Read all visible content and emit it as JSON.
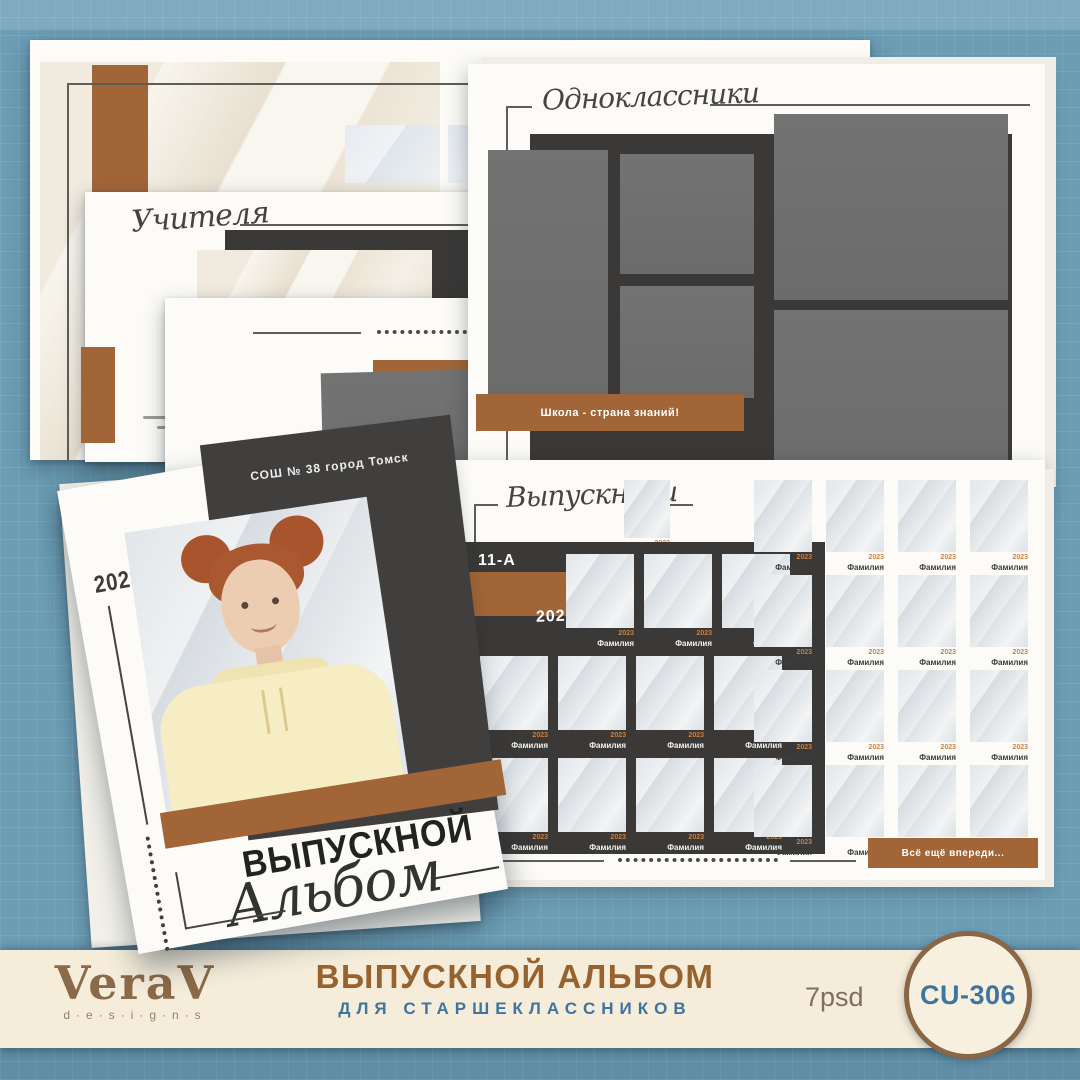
{
  "palette": {
    "background_blue": "#6b9db5",
    "paper_white": "#fcfbf7",
    "charcoal": "#3b3937",
    "photo_placeholder_gray": "#6e6e6e",
    "accent_brown": "#a16538",
    "footer_cream": "#f5ecda",
    "footer_title_brown": "#98622e",
    "footer_subtitle_blue": "#3e74a0",
    "badge_border_brown": "#8a6646"
  },
  "pages": {
    "graduate_page": {
      "title": "Выпускник"
    },
    "teachers_page": {
      "title": "Учителя"
    },
    "classmates_page": {
      "title": "Одноклассники",
      "banner": "Школа - страна знаний!"
    },
    "graduates_page": {
      "title": "Выпускники",
      "class_label": "11-А",
      "year": "2023",
      "banner": "Всё ещё впереди...",
      "tile_year": "2023",
      "tile_name": "Фамилия"
    }
  },
  "cover": {
    "school_name": "СОШ № 38 город Томск",
    "year": "2023",
    "title_caps": "ВЫПУСКНОЙ",
    "title_script": "Альбом"
  },
  "footer": {
    "brand": "VeraV",
    "brand_sub": "d·e·s·i·g·n·s",
    "title": "ВЫПУСКНОЙ АЛЬБОМ",
    "subtitle": "ДЛЯ СТАРШЕКЛАССНИКОВ",
    "format": "7psd",
    "code": "CU-306"
  }
}
